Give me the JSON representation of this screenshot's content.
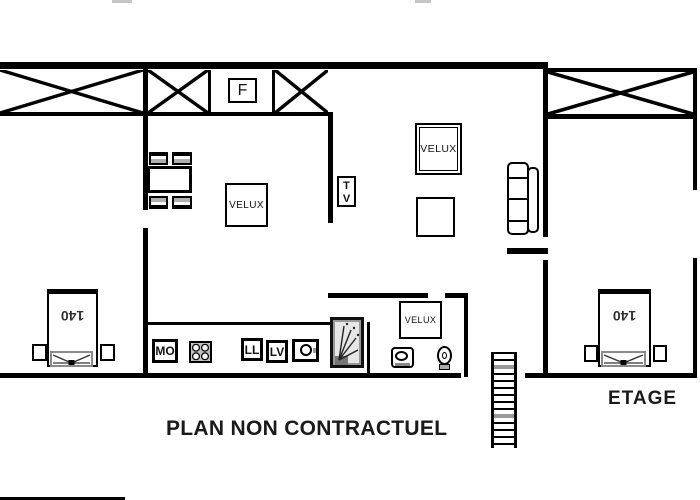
{
  "plan": {
    "caption": "PLAN NON CONTRACTUEL",
    "floor_label": "ETAGE",
    "velux_label": "VELUX",
    "fridge_label": "F",
    "tv_line1": "T",
    "tv_line2": "V",
    "microwave_label": "MO",
    "washing_machine_label": "LL",
    "dishwasher_label": "LV",
    "bed_size_label": "140"
  },
  "colors": {
    "wall": "#000000",
    "text": "#1a1a1a",
    "shading": "#aaaaaa"
  }
}
